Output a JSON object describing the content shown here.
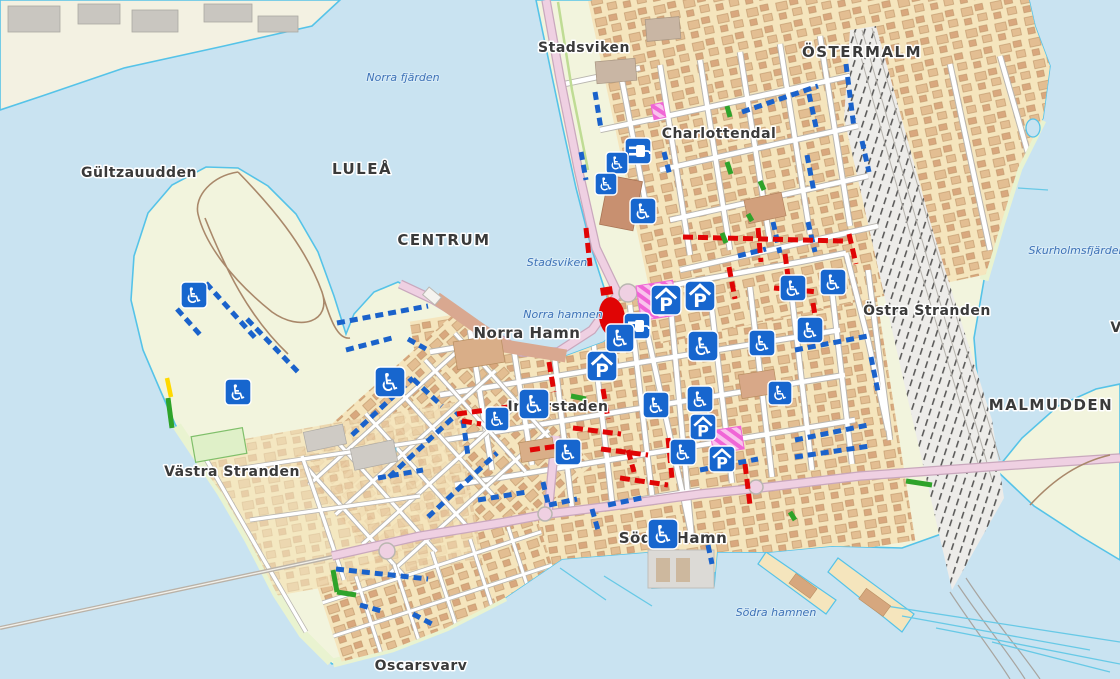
{
  "map": {
    "colors": {
      "water": "#C9E3F1",
      "coast": "#55C3E8",
      "land": "#F2F4DD",
      "land_pale": "#F3F1E2",
      "urban": "#F5E5BD",
      "building": "#E3BE92",
      "building2": "#D9A87E",
      "building_edge": "#BE9569",
      "road": "#FFFFFF",
      "casing": "#B9B6B0",
      "pink_road": "#EFD0E2",
      "pink_case": "#C9A8BD",
      "rail_bg": "#EDECE9",
      "park_path": "#A9886A",
      "icon_blue": "#1766CE",
      "seg_blue": "#1A62CB",
      "seg_red": "#E00505",
      "seg_green": "#2FA32A",
      "seg_yellow": "#FFD900",
      "magenta": "#F066D6",
      "magenta_bg": "#F9C3EC",
      "label_dark": "#3A3A3A",
      "label_water": "#3F73B7"
    },
    "glyphs": {
      "wheelchair": "♿",
      "garage": "P"
    },
    "place_labels": [
      {
        "text": "Stadsviken",
        "x": 584,
        "y": 52,
        "size": 14,
        "spacing": 0.5
      },
      {
        "text": "ÖSTERMALM",
        "x": 862,
        "y": 57,
        "size": 15,
        "spacing": 1.5
      },
      {
        "text": "Charlottendal",
        "x": 719,
        "y": 138,
        "size": 14,
        "spacing": 0.5
      },
      {
        "text": "Gültzauudden",
        "x": 139,
        "y": 177,
        "size": 14,
        "spacing": 0.5
      },
      {
        "text": "LULEÅ",
        "x": 362,
        "y": 174,
        "size": 15,
        "spacing": 1.5
      },
      {
        "text": "CENTRUM",
        "x": 444,
        "y": 245,
        "size": 15,
        "spacing": 1.5
      },
      {
        "text": "Norra Hamn",
        "x": 527,
        "y": 338,
        "size": 15,
        "spacing": 0.5
      },
      {
        "text": "Östra Stranden",
        "x": 927,
        "y": 315,
        "size": 14,
        "spacing": 0.5
      },
      {
        "text": "MALMUDDEN",
        "x": 1051,
        "y": 410,
        "size": 15,
        "spacing": 1.5
      },
      {
        "text": "Västra Stranden",
        "x": 232,
        "y": 476,
        "size": 14,
        "spacing": 0.5
      },
      {
        "text": "Innerstaden",
        "x": 558,
        "y": 411,
        "size": 14,
        "spacing": 0.5
      },
      {
        "text": "Södra Hamn",
        "x": 673,
        "y": 543,
        "size": 15,
        "spacing": 0.5
      },
      {
        "text": "Oscarsvarv",
        "x": 421,
        "y": 670,
        "size": 14,
        "spacing": 0.5
      },
      {
        "text": "V",
        "x": 1116,
        "y": 332,
        "size": 14,
        "spacing": 0.5
      }
    ],
    "water_labels": [
      {
        "text": "Norra fjärden",
        "x": 403,
        "y": 81
      },
      {
        "text": "Stadsviken",
        "x": 557,
        "y": 266
      },
      {
        "text": "Norra hamnen",
        "x": 563,
        "y": 318
      },
      {
        "text": "Skurholmsfjärden",
        "x": 1077,
        "y": 254
      },
      {
        "text": "Södra hamnen",
        "x": 776,
        "y": 616
      }
    ],
    "icons": [
      {
        "type": "plug",
        "x": 638,
        "y": 151,
        "s": 26
      },
      {
        "type": "plug",
        "x": 637,
        "y": 326,
        "s": 26
      },
      {
        "type": "garage",
        "x": 666,
        "y": 300,
        "s": 30
      },
      {
        "type": "garage",
        "x": 700,
        "y": 296,
        "s": 30
      },
      {
        "type": "garage",
        "x": 602,
        "y": 366,
        "s": 30
      },
      {
        "type": "garage",
        "x": 703,
        "y": 427,
        "s": 26
      },
      {
        "type": "garage",
        "x": 722,
        "y": 459,
        "s": 26
      },
      {
        "type": "wheelchair",
        "x": 194,
        "y": 295,
        "s": 26
      },
      {
        "type": "wheelchair",
        "x": 238,
        "y": 392,
        "s": 26
      },
      {
        "type": "wheelchair",
        "x": 390,
        "y": 382,
        "s": 30
      },
      {
        "type": "wheelchair",
        "x": 497,
        "y": 419,
        "s": 24
      },
      {
        "type": "wheelchair",
        "x": 534,
        "y": 404,
        "s": 30
      },
      {
        "type": "wheelchair",
        "x": 568,
        "y": 452,
        "s": 26
      },
      {
        "type": "wheelchair",
        "x": 617,
        "y": 163,
        "s": 22
      },
      {
        "type": "wheelchair",
        "x": 606,
        "y": 184,
        "s": 22
      },
      {
        "type": "wheelchair",
        "x": 643,
        "y": 211,
        "s": 26
      },
      {
        "type": "wheelchair",
        "x": 620,
        "y": 338,
        "s": 28
      },
      {
        "type": "wheelchair",
        "x": 703,
        "y": 346,
        "s": 30
      },
      {
        "type": "wheelchair",
        "x": 656,
        "y": 405,
        "s": 26
      },
      {
        "type": "wheelchair",
        "x": 700,
        "y": 399,
        "s": 26
      },
      {
        "type": "wheelchair",
        "x": 762,
        "y": 343,
        "s": 26
      },
      {
        "type": "wheelchair",
        "x": 793,
        "y": 288,
        "s": 26
      },
      {
        "type": "wheelchair",
        "x": 833,
        "y": 282,
        "s": 26
      },
      {
        "type": "wheelchair",
        "x": 810,
        "y": 330,
        "s": 26
      },
      {
        "type": "wheelchair",
        "x": 780,
        "y": 393,
        "s": 24
      },
      {
        "type": "wheelchair",
        "x": 683,
        "y": 452,
        "s": 26
      },
      {
        "type": "wheelchair",
        "x": 663,
        "y": 534,
        "s": 30
      }
    ],
    "zones": [
      {
        "kind": "pedestrian-area",
        "x": 636,
        "y": 286,
        "w": 37,
        "h": 35,
        "rot": -9
      },
      {
        "kind": "pedestrian-area",
        "x": 710,
        "y": 431,
        "w": 31,
        "h": 23,
        "rot": -9
      },
      {
        "kind": "pedestrian-area",
        "x": 651,
        "y": 105,
        "w": 12,
        "h": 15,
        "rot": -12
      },
      {
        "kind": "restricted-area",
        "shape": "ellipse",
        "x": 612,
        "y": 317,
        "w": 26,
        "h": 40,
        "rot": -8
      },
      {
        "kind": "restricted-area",
        "shape": "rect",
        "x": 600,
        "y": 288,
        "w": 12,
        "h": 8,
        "rot": -9
      }
    ],
    "segments": [
      {
        "color": "blue",
        "pts": [
          206,
          283,
          258,
          341
        ]
      },
      {
        "color": "blue",
        "pts": [
          177,
          309,
          203,
          338
        ]
      },
      {
        "color": "blue",
        "pts": [
          247,
          319,
          299,
          373
        ]
      },
      {
        "color": "blue",
        "pts": [
          337,
          323,
          428,
          306
        ]
      },
      {
        "color": "blue",
        "pts": [
          346,
          350,
          392,
          338
        ]
      },
      {
        "color": "blue",
        "pts": [
          352,
          435,
          413,
          378
        ]
      },
      {
        "color": "blue",
        "pts": [
          389,
          477,
          458,
          413
        ]
      },
      {
        "color": "blue",
        "pts": [
          428,
          517,
          497,
          453
        ]
      },
      {
        "color": "blue",
        "pts": [
          413,
          379,
          442,
          406
        ]
      },
      {
        "color": "blue",
        "pts": [
          463,
          420,
          468,
          456
        ]
      },
      {
        "color": "blue",
        "pts": [
          378,
          478,
          423,
          470
        ]
      },
      {
        "color": "blue",
        "pts": [
          478,
          500,
          527,
          492
        ]
      },
      {
        "color": "blue",
        "pts": [
          543,
          482,
          548,
          503
        ]
      },
      {
        "color": "blue",
        "pts": [
          592,
          509,
          598,
          530
        ]
      },
      {
        "color": "blue",
        "pts": [
          549,
          505,
          577,
          499
        ]
      },
      {
        "color": "blue",
        "pts": [
          608,
          505,
          646,
          497
        ]
      },
      {
        "color": "blue",
        "pts": [
          708,
          545,
          712,
          564
        ]
      },
      {
        "color": "blue",
        "pts": [
          336,
          569,
          428,
          579
        ]
      },
      {
        "color": "blue",
        "pts": [
          360,
          605,
          385,
          612
        ]
      },
      {
        "color": "blue",
        "pts": [
          413,
          614,
          432,
          624
        ]
      },
      {
        "color": "blue",
        "pts": [
          408,
          339,
          426,
          349
        ]
      },
      {
        "color": "blue",
        "pts": [
          595,
          92,
          601,
          129
        ]
      },
      {
        "color": "blue",
        "pts": [
          581,
          152,
          586,
          180
        ]
      },
      {
        "color": "blue",
        "pts": [
          664,
          152,
          670,
          176
        ]
      },
      {
        "color": "blue",
        "pts": [
          742,
          112,
          818,
          86
        ]
      },
      {
        "color": "blue",
        "pts": [
          809,
          94,
          816,
          127
        ]
      },
      {
        "color": "blue",
        "pts": [
          846,
          64,
          854,
          128
        ]
      },
      {
        "color": "blue",
        "pts": [
          807,
          155,
          814,
          192
        ]
      },
      {
        "color": "blue",
        "pts": [
          862,
          141,
          869,
          172
        ]
      },
      {
        "color": "blue",
        "pts": [
          773,
          222,
          780,
          253
        ]
      },
      {
        "color": "blue",
        "pts": [
          738,
          256,
          766,
          249
        ]
      },
      {
        "color": "blue",
        "pts": [
          808,
          222,
          815,
          252
        ]
      },
      {
        "color": "blue",
        "pts": [
          795,
          350,
          868,
          336
        ]
      },
      {
        "color": "blue",
        "pts": [
          795,
          440,
          868,
          425
        ]
      },
      {
        "color": "blue",
        "pts": [
          871,
          357,
          878,
          392
        ]
      },
      {
        "color": "blue",
        "pts": [
          795,
          457,
          870,
          446
        ]
      },
      {
        "color": "blue",
        "pts": [
          700,
          470,
          758,
          459
        ]
      },
      {
        "color": "red",
        "pts": [
          683,
          237,
          843,
          241
        ]
      },
      {
        "color": "red",
        "pts": [
          758,
          228,
          761,
          262
        ]
      },
      {
        "color": "red",
        "pts": [
          729,
          267,
          735,
          299
        ]
      },
      {
        "color": "red",
        "pts": [
          785,
          254,
          791,
          299
        ]
      },
      {
        "color": "red",
        "pts": [
          774,
          288,
          818,
          292
        ]
      },
      {
        "color": "red",
        "pts": [
          813,
          303,
          820,
          347
        ]
      },
      {
        "color": "red",
        "pts": [
          849,
          234,
          856,
          264
        ]
      },
      {
        "color": "red",
        "pts": [
          549,
          362,
          554,
          392
        ]
      },
      {
        "color": "red",
        "pts": [
          457,
          414,
          530,
          404
        ]
      },
      {
        "color": "red",
        "pts": [
          573,
          428,
          621,
          434
        ]
      },
      {
        "color": "red",
        "pts": [
          603,
          389,
          608,
          419
        ]
      },
      {
        "color": "red",
        "pts": [
          668,
          438,
          672,
          478
        ]
      },
      {
        "color": "red",
        "pts": [
          745,
          464,
          750,
          505
        ]
      },
      {
        "color": "red",
        "pts": [
          601,
          449,
          648,
          455
        ]
      },
      {
        "color": "red",
        "pts": [
          620,
          478,
          668,
          485
        ]
      },
      {
        "color": "red",
        "pts": [
          530,
          450,
          558,
          446
        ]
      },
      {
        "color": "red",
        "pts": [
          628,
          450,
          634,
          472
        ]
      },
      {
        "color": "red",
        "pts": [
          586,
          228,
          590,
          266
        ]
      },
      {
        "color": "red",
        "pts": [
          462,
          421,
          481,
          424
        ]
      },
      {
        "color": "green",
        "pts": [
          168,
          398,
          172,
          428
        ]
      },
      {
        "color": "green",
        "pts": [
          333,
          570,
          337,
          592
        ]
      },
      {
        "color": "green",
        "pts": [
          337,
          592,
          356,
          595
        ]
      },
      {
        "color": "green",
        "pts": [
          571,
          396,
          586,
          399
        ]
      },
      {
        "color": "green",
        "pts": [
          727,
          162,
          731,
          174
        ]
      },
      {
        "color": "green",
        "pts": [
          760,
          181,
          764,
          190
        ]
      },
      {
        "color": "green",
        "pts": [
          748,
          214,
          752,
          221
        ]
      },
      {
        "color": "green",
        "pts": [
          722,
          233,
          726,
          243
        ]
      },
      {
        "color": "green",
        "pts": [
          727,
          106,
          730,
          117
        ]
      },
      {
        "color": "green",
        "pts": [
          906,
          481,
          932,
          485
        ]
      },
      {
        "color": "green",
        "pts": [
          790,
          512,
          795,
          520
        ]
      },
      {
        "color": "yellow",
        "pts": [
          167,
          378,
          171,
          397
        ]
      }
    ]
  }
}
